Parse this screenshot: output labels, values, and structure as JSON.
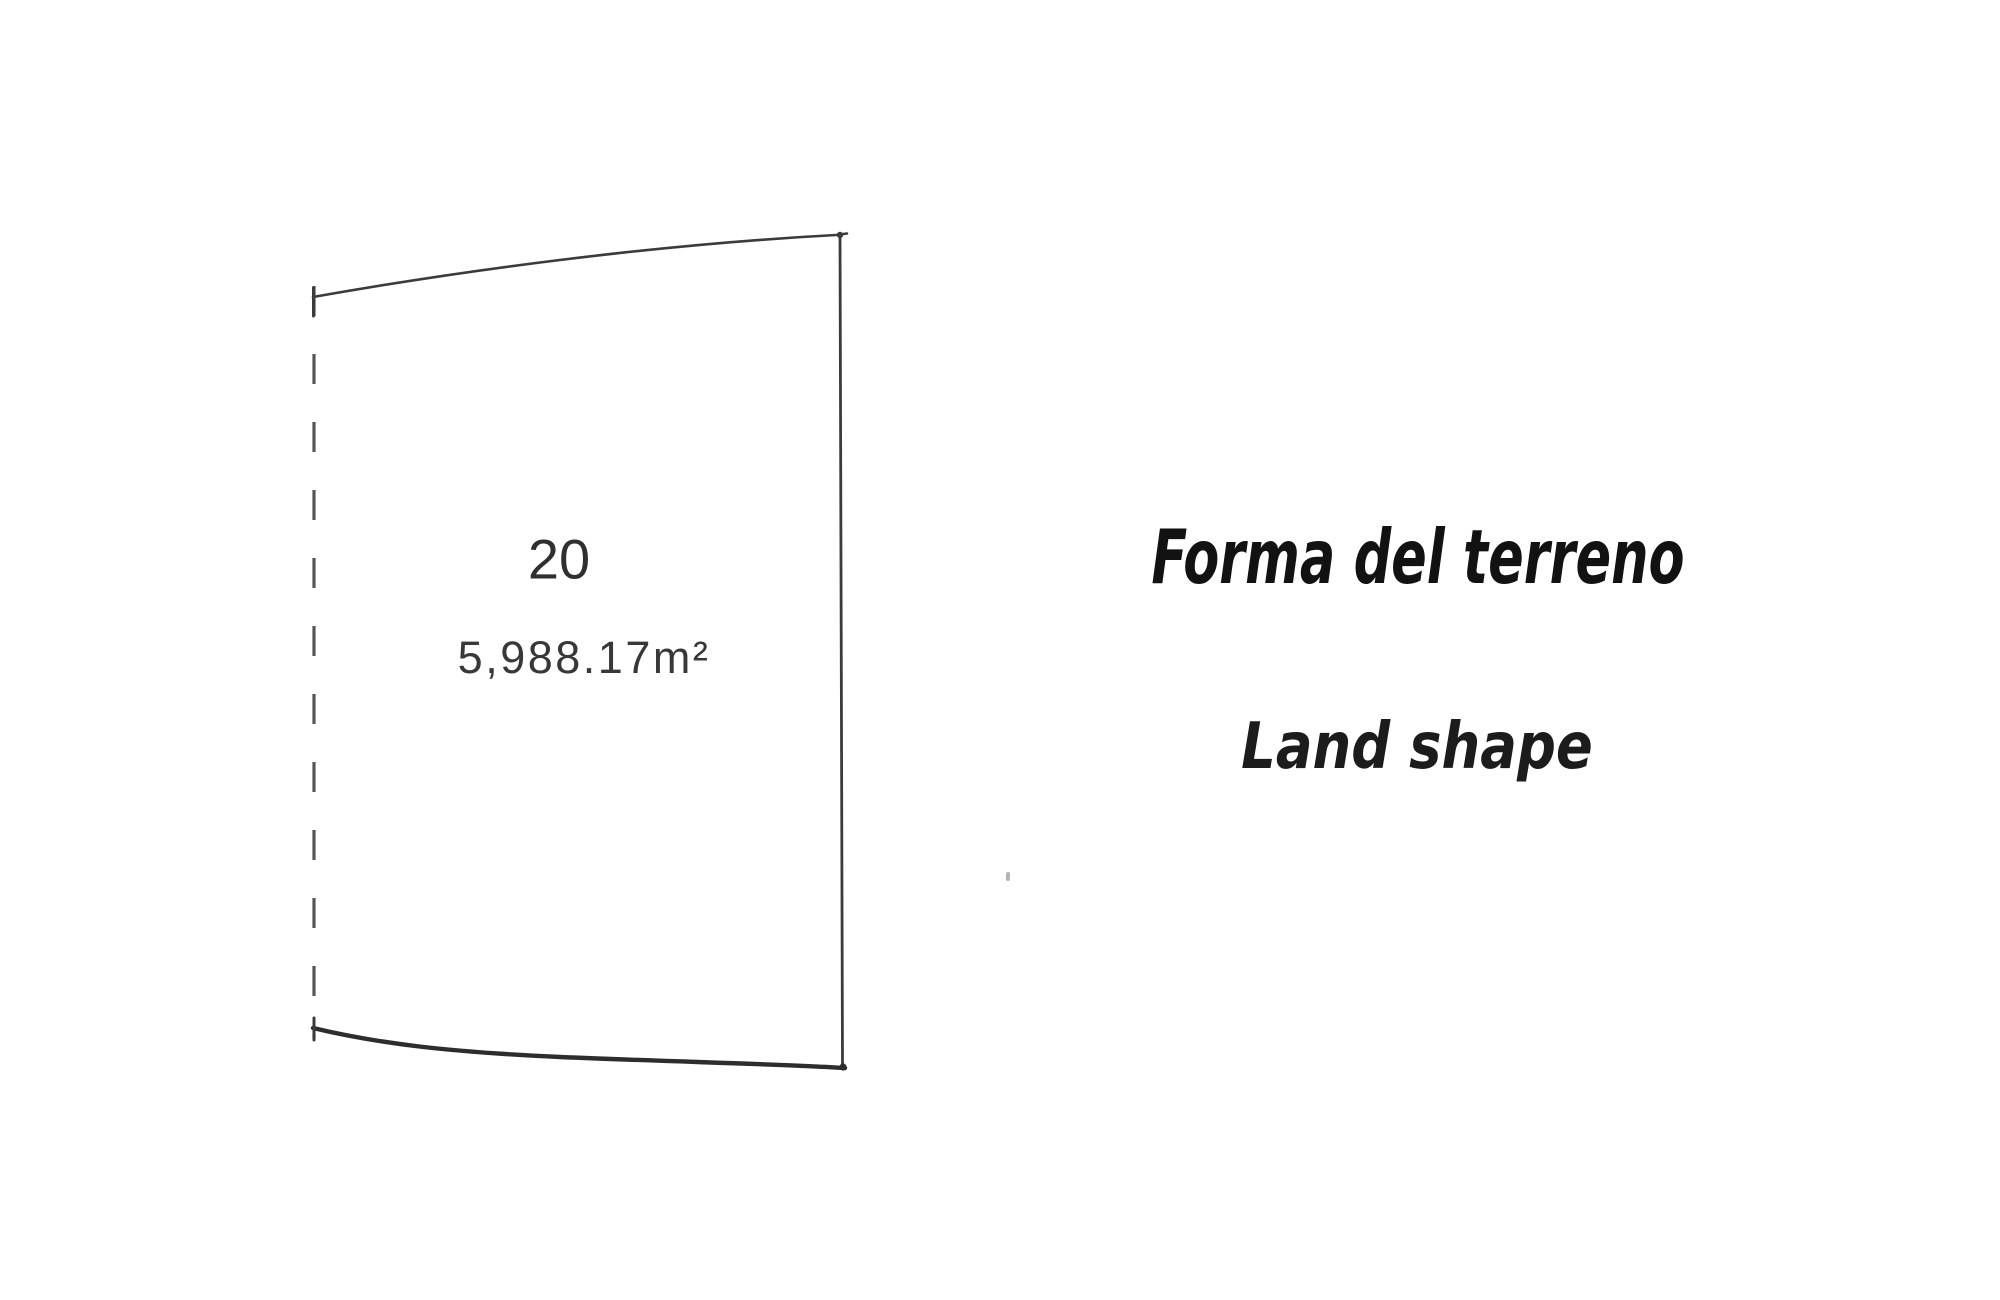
{
  "parcel": {
    "lot_number": "20",
    "area": "5,988.17m²"
  },
  "labels": {
    "title_italian": "Forma del terreno",
    "title_english": "Land shape"
  },
  "colors": {
    "outline": "#3b3b3b",
    "outline_bottom": "#2d2d2d",
    "dashed_boundary": "#565656",
    "parcel_text": "#333333",
    "title_ink": "#121212",
    "background": "#ffffff"
  }
}
